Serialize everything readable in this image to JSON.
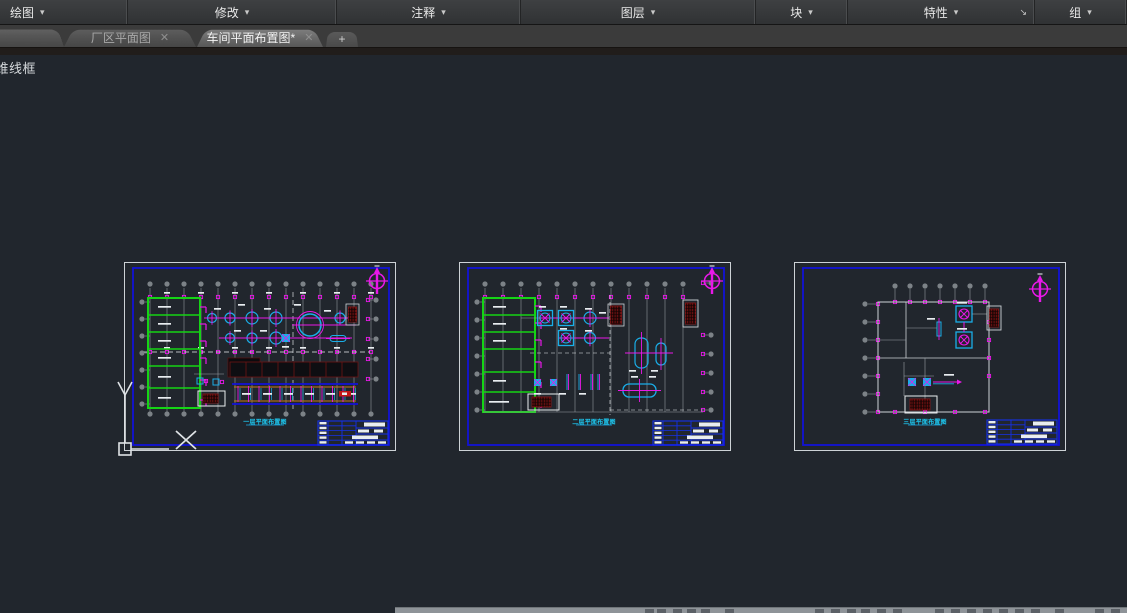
{
  "ribbon": {
    "panels": [
      {
        "label": "绘图"
      },
      {
        "label": "修改"
      },
      {
        "label": "注释"
      },
      {
        "label": "图层"
      },
      {
        "label": "块"
      },
      {
        "label": "特性",
        "launcher": "↘"
      },
      {
        "label": "组"
      }
    ],
    "caret": "▾"
  },
  "tabs": {
    "items": [
      {
        "label": "厂区平面图",
        "close": "✕",
        "active": false
      },
      {
        "label": "车间平面布置图*",
        "close": "✕",
        "active": true
      }
    ],
    "new_tab_label": "+"
  },
  "viewport": {
    "visual_style_label": "二维线框"
  },
  "ucs": {
    "x_label": "X",
    "y_label": "Y"
  },
  "sheets": [
    {
      "title": "一层平面布置图"
    },
    {
      "title": "二层平面布置图"
    },
    {
      "title": "三层平面布置图"
    }
  ],
  "colors": {
    "canvas_bg": "#21262d",
    "sheet_outline_white": "#cdd2d6",
    "border_blue": "#1212d8",
    "titleblock_blue": "#1530e8",
    "wall_green": "#15d415",
    "equip_cyan": "#1aaee8",
    "annot_magenta": "#e818e8",
    "grid_gray": "#9aa0a5",
    "hatch_red": "#8a1616",
    "hatch_red_fill": "#2a0808",
    "conveyor_orange": "#c87818",
    "line_white": "#e9edf0"
  }
}
